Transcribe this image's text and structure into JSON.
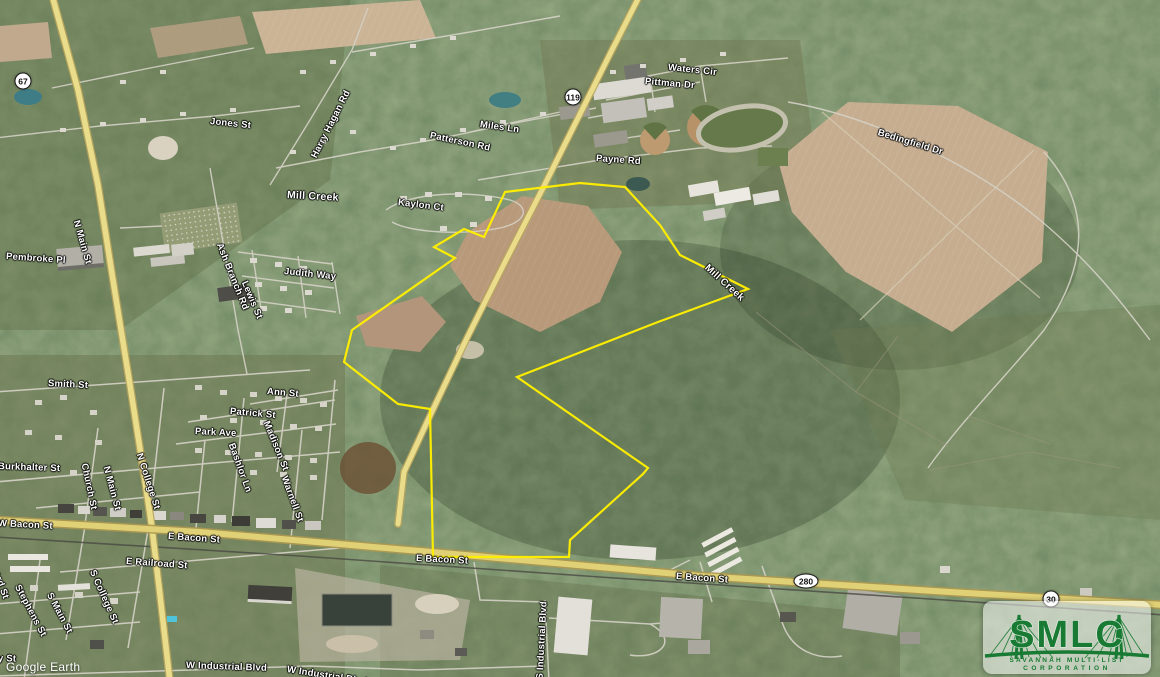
{
  "map": {
    "watermark": "Google Earth",
    "street_labels": [
      {
        "t": "Jones St",
        "x": 210,
        "y": 116,
        "r": 6
      },
      {
        "t": "Harry Hagan Rd",
        "x": 314,
        "y": 152,
        "r": -63
      },
      {
        "t": "Patterson Rd",
        "x": 430,
        "y": 130,
        "r": 12
      },
      {
        "t": "Miles Ln",
        "x": 480,
        "y": 119,
        "r": 8
      },
      {
        "t": "Waters Cir",
        "x": 668,
        "y": 62,
        "r": 6
      },
      {
        "t": "Pittman Dr",
        "x": 645,
        "y": 76,
        "r": 5
      },
      {
        "t": "Payne Rd",
        "x": 596,
        "y": 153,
        "r": 4
      },
      {
        "t": "Bedingfield Dr",
        "x": 878,
        "y": 127,
        "r": 17
      },
      {
        "t": "Mill Creek",
        "x": 287,
        "y": 189,
        "r": 3,
        "s": 10.5
      },
      {
        "t": "Kaylon Ct",
        "x": 398,
        "y": 197,
        "r": 7
      },
      {
        "t": "Pembroke Pl",
        "x": 6,
        "y": 251,
        "r": 4
      },
      {
        "t": "N Main St",
        "x": 76,
        "y": 215,
        "r": 74
      },
      {
        "t": "Ash Branch Rd",
        "x": 219,
        "y": 238,
        "r": 68
      },
      {
        "t": "Lewis St",
        "x": 244,
        "y": 276,
        "r": 67
      },
      {
        "t": "Judith Way",
        "x": 284,
        "y": 266,
        "r": 6
      },
      {
        "t": "Mill Creek",
        "x": 706,
        "y": 261,
        "r": 42,
        "s": 10
      },
      {
        "t": "Smith St",
        "x": 48,
        "y": 378,
        "r": 3
      },
      {
        "t": "Ann St",
        "x": 267,
        "y": 386,
        "r": 5
      },
      {
        "t": "Patrick St",
        "x": 230,
        "y": 406,
        "r": 5
      },
      {
        "t": "Park Ave",
        "x": 195,
        "y": 426,
        "r": 3
      },
      {
        "t": "Burkhalter St",
        "x": -2,
        "y": 461,
        "r": 2
      },
      {
        "t": "Church St",
        "x": 84,
        "y": 458,
        "r": 78
      },
      {
        "t": "N Main St",
        "x": 106,
        "y": 461,
        "r": 75
      },
      {
        "t": "N College St",
        "x": 139,
        "y": 448,
        "r": 72
      },
      {
        "t": "Bashlor Ln",
        "x": 231,
        "y": 438,
        "r": 70
      },
      {
        "t": "Madison St",
        "x": 266,
        "y": 416,
        "r": 68
      },
      {
        "t": "Warnell St",
        "x": 284,
        "y": 471,
        "r": 70
      },
      {
        "t": "W Bacon St",
        "x": -2,
        "y": 518,
        "r": 3
      },
      {
        "t": "E Bacon St",
        "x": 168,
        "y": 531,
        "r": 4
      },
      {
        "t": "E Railroad St",
        "x": 126,
        "y": 556,
        "r": 4
      },
      {
        "t": "ord St",
        "x": -4,
        "y": 566,
        "r": 70
      },
      {
        "t": "Stephens St",
        "x": 17,
        "y": 580,
        "r": 62
      },
      {
        "t": "S Main St",
        "x": 49,
        "y": 588,
        "r": 62
      },
      {
        "t": "S College St",
        "x": 92,
        "y": 565,
        "r": 66
      },
      {
        "t": "y St",
        "x": -2,
        "y": 653,
        "r": 2
      },
      {
        "t": "E Bacon St",
        "x": 416,
        "y": 553,
        "r": 3
      },
      {
        "t": "E Bacon St",
        "x": 676,
        "y": 571,
        "r": 4
      },
      {
        "t": "S Industrial Blvd",
        "x": 540,
        "y": 674,
        "r": -87
      },
      {
        "t": "W Industrial Blvd",
        "x": 186,
        "y": 660,
        "r": 2
      },
      {
        "t": "W Industrial Blvd",
        "x": 287,
        "y": 664,
        "r": 9
      }
    ],
    "shields": [
      {
        "t": "67",
        "x": 23,
        "y": 81,
        "oval": false
      },
      {
        "t": "119",
        "x": 573,
        "y": 97,
        "oval": false
      },
      {
        "t": "280",
        "x": 806,
        "y": 581,
        "oval": true
      },
      {
        "t": "30",
        "x": 1051,
        "y": 599,
        "oval": false
      }
    ],
    "parcel": {
      "color": "#ffee00",
      "points": [
        [
          505,
          192
        ],
        [
          580,
          183
        ],
        [
          625,
          187
        ],
        [
          660,
          225
        ],
        [
          680,
          255
        ],
        [
          748,
          289
        ],
        [
          658,
          322
        ],
        [
          517,
          377
        ],
        [
          648,
          468
        ],
        [
          643,
          474
        ],
        [
          570,
          540
        ],
        [
          569,
          557
        ],
        [
          433,
          557
        ],
        [
          430,
          409
        ],
        [
          398,
          404
        ],
        [
          344,
          362
        ],
        [
          352,
          330
        ],
        [
          455,
          258
        ],
        [
          434,
          247
        ],
        [
          464,
          229
        ],
        [
          484,
          237
        ]
      ]
    }
  },
  "logo": {
    "acronym": "SMLC",
    "line1": "SAVANNAH MULTI-LIST",
    "line2": "CORPORATION",
    "green": "#187a33"
  }
}
